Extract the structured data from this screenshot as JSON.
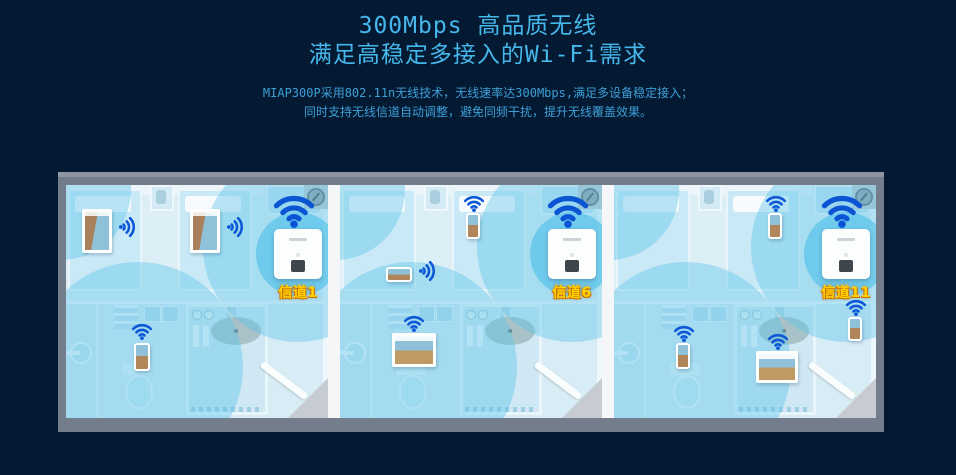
{
  "page": {
    "background_color": "#041a33"
  },
  "header": {
    "title": "300Mbps 高品质无线",
    "subtitle": "满足高稳定多接入的Wi-Fi需求",
    "description_line1": "MIAP300P采用802.11n无线技术，无线速率达300Mbps,满足多设备稳定接入；",
    "description_line2": "同时支持无线信道自动调整，避免同频干扰，提升无线覆盖效果。",
    "title_color": "#45b7ea",
    "description_color": "#3d9fd6"
  },
  "figure": {
    "frame_color": "#76808e",
    "wifi_icon_color": "#0b55d4",
    "channel_label_color": "#ffd400",
    "coverage_color": "rgba(88,195,233,0.40)",
    "icons": {
      "wifi_signal": "wifi-signal-icon",
      "access_point": "wall-mount-access-point",
      "ceiling_fixture": "ceiling-sprinkler-icon"
    },
    "rooms": [
      {
        "channel_label": "信道1",
        "devices": [
          {
            "type": "tablet-portrait",
            "x": 16,
            "y": 24,
            "w": 30,
            "h": 44,
            "wifi_dir": "right",
            "wifi_x": 50,
            "wifi_y": 32
          },
          {
            "type": "tablet-portrait",
            "x": 124,
            "y": 24,
            "w": 30,
            "h": 44,
            "wifi_dir": "right",
            "wifi_x": 158,
            "wifi_y": 32
          },
          {
            "type": "phone-portrait",
            "x": 68,
            "y": 158,
            "w": 16,
            "h": 28,
            "wifi_dir": "up",
            "wifi_x": 64,
            "wifi_y": 136
          }
        ]
      },
      {
        "channel_label": "信道6",
        "devices": [
          {
            "type": "phone-landscape",
            "x": 46,
            "y": 82,
            "w": 26,
            "h": 15,
            "wifi_dir": "right",
            "wifi_x": 76,
            "wifi_y": 76
          },
          {
            "type": "phone-portrait",
            "x": 126,
            "y": 28,
            "w": 14,
            "h": 26,
            "wifi_dir": "up",
            "wifi_x": 122,
            "wifi_y": 8
          },
          {
            "type": "tablet-landscape",
            "x": 52,
            "y": 148,
            "w": 44,
            "h": 34,
            "wifi_dir": "up",
            "wifi_x": 62,
            "wifi_y": 128
          }
        ]
      },
      {
        "channel_label": "信道11",
        "devices": [
          {
            "type": "phone-portrait",
            "x": 154,
            "y": 28,
            "w": 14,
            "h": 26,
            "wifi_dir": "up",
            "wifi_x": 150,
            "wifi_y": 8
          },
          {
            "type": "phone-portrait",
            "x": 234,
            "y": 132,
            "w": 14,
            "h": 24,
            "wifi_dir": "up",
            "wifi_x": 230,
            "wifi_y": 112
          },
          {
            "type": "phone-portrait",
            "x": 62,
            "y": 158,
            "w": 14,
            "h": 26,
            "wifi_dir": "up",
            "wifi_x": 58,
            "wifi_y": 138
          },
          {
            "type": "tablet-landscape",
            "x": 142,
            "y": 166,
            "w": 42,
            "h": 32,
            "wifi_dir": "up",
            "wifi_x": 152,
            "wifi_y": 146
          }
        ]
      }
    ]
  }
}
